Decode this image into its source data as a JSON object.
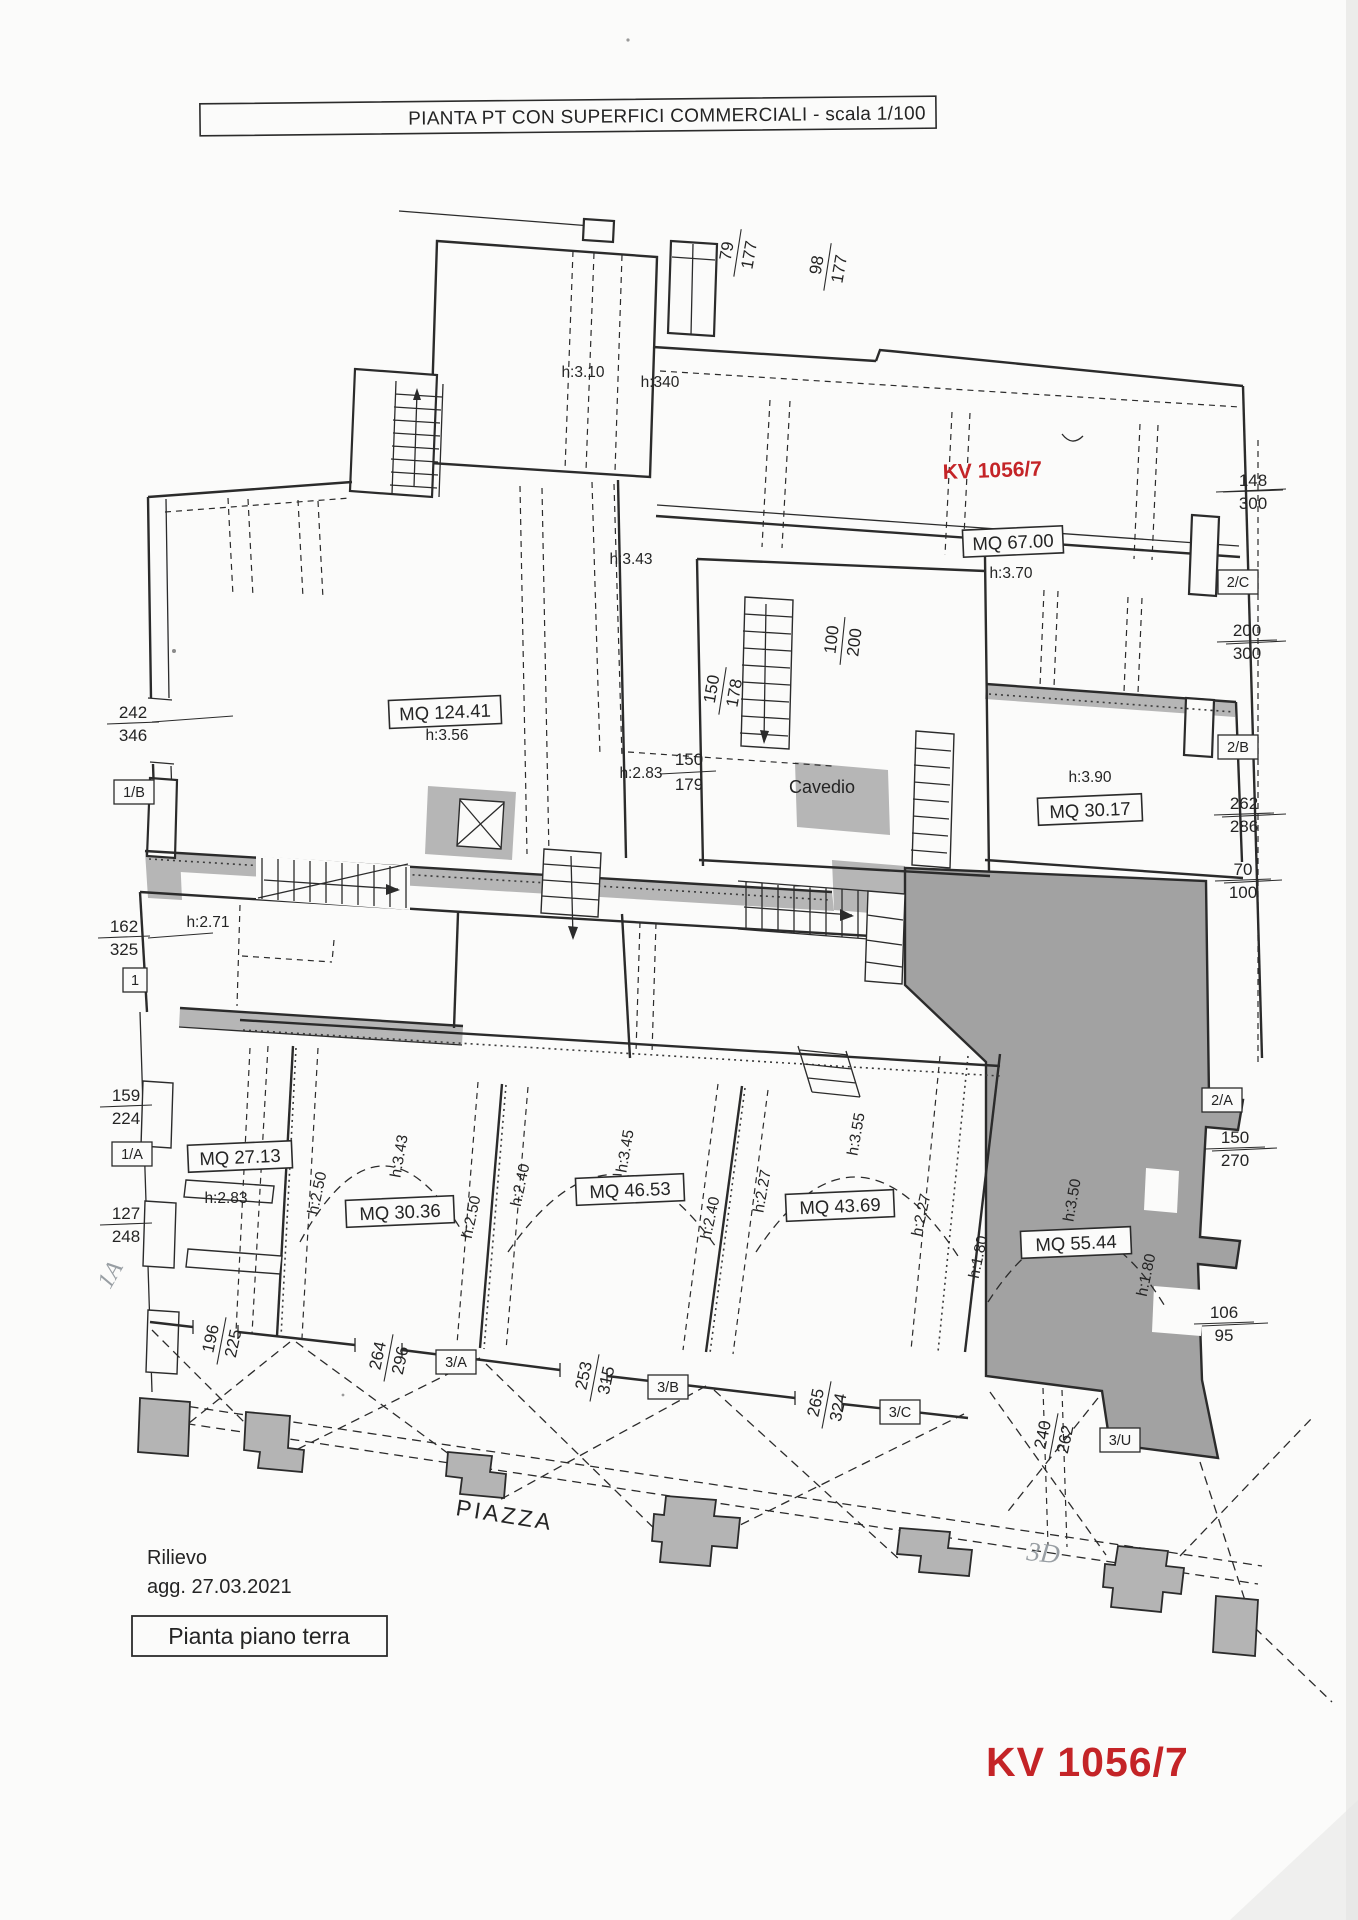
{
  "title": "PIANTA PT CON SUPERFICI COMMERCIALI - scala 1/100",
  "stamps": {
    "kv_top": "KV 1056/7",
    "kv_bottom": "KV 1056/7"
  },
  "annotations": {
    "cavedio": "Cavedio",
    "piazza": "PIAZZA",
    "survey_line1": "Rilievo",
    "survey_line2": "agg. 27.03.2021",
    "caption": "Pianta piano terra",
    "handwritten_left": "1A",
    "handwritten_right": "3D"
  },
  "rooms": {
    "r67": {
      "mq": "MQ 67.00",
      "h": "h:3.70"
    },
    "r124": {
      "mq": "MQ 124.41",
      "h": "h:3.56"
    },
    "r3017": {
      "mq": "MQ 30.17",
      "h": "h:3.90"
    },
    "r2713": {
      "mq": "MQ 27.13",
      "h": "h:2.83"
    },
    "r3036": {
      "mq": "MQ 30.36",
      "h": "h:3.43"
    },
    "r4653": {
      "mq": "MQ 46.53",
      "h": "h:3.45"
    },
    "r4369": {
      "mq": "MQ 43.69",
      "h": "h:3.55"
    },
    "r5544": {
      "mq": "MQ 55.44",
      "h": "h:3.50"
    }
  },
  "heights": {
    "h310": "h:3.10",
    "h340": "h:340",
    "h343": "h:3.43",
    "h271": "h:2.71",
    "h283": "h:2.83",
    "h250a": "h:2.50",
    "h250b": "h:2.50",
    "h240a": "h:2.40",
    "h240b": "h:2.40",
    "h227a": "h:2.27",
    "h227b": "h:2.27",
    "h180a": "h:1.80",
    "h180b": "h:1.80"
  },
  "dims": {
    "d79_177": {
      "a": "79",
      "b": "177"
    },
    "d98_177": {
      "a": "98",
      "b": "177"
    },
    "d148_300": {
      "a": "148",
      "b": "300"
    },
    "d200_300": {
      "a": "200",
      "b": "300"
    },
    "d262_286": {
      "a": "262",
      "b": "286"
    },
    "d70_100": {
      "a": "70",
      "b": "100"
    },
    "d150_270": {
      "a": "150",
      "b": "270"
    },
    "d106_95": {
      "a": "106",
      "b": "95"
    },
    "d242_346": {
      "a": "242",
      "b": "346"
    },
    "d162_325": {
      "a": "162",
      "b": "325"
    },
    "d159_224": {
      "a": "159",
      "b": "224"
    },
    "d127_248": {
      "a": "127",
      "b": "248"
    },
    "d100_200": {
      "a": "100",
      "b": "200"
    },
    "d150_178": {
      "a": "150",
      "b": "178"
    },
    "d150_179": {
      "a": "150",
      "b": "179"
    },
    "d196_225": {
      "a": "196",
      "b": "225"
    },
    "d264_296": {
      "a": "264",
      "b": "296"
    },
    "d253_315": {
      "a": "253",
      "b": "315"
    },
    "d265_324": {
      "a": "265",
      "b": "324"
    },
    "d240_262": {
      "a": "240",
      "b": "262"
    }
  },
  "tags": {
    "t1b": "1/B",
    "t1": "1",
    "t1a": "1/A",
    "t2c": "2/C",
    "t2b": "2/B",
    "t2a": "2/A",
    "t3a": "3/A",
    "t3b": "3/B",
    "t3c": "3/C",
    "t3u": "3/U"
  },
  "colors": {
    "ink": "#2b2b2b",
    "accent_red": "#c42427",
    "shade_light": "#b6b6b6",
    "shade_dark": "#a2a2a2",
    "paper": "#fbfbfa"
  }
}
